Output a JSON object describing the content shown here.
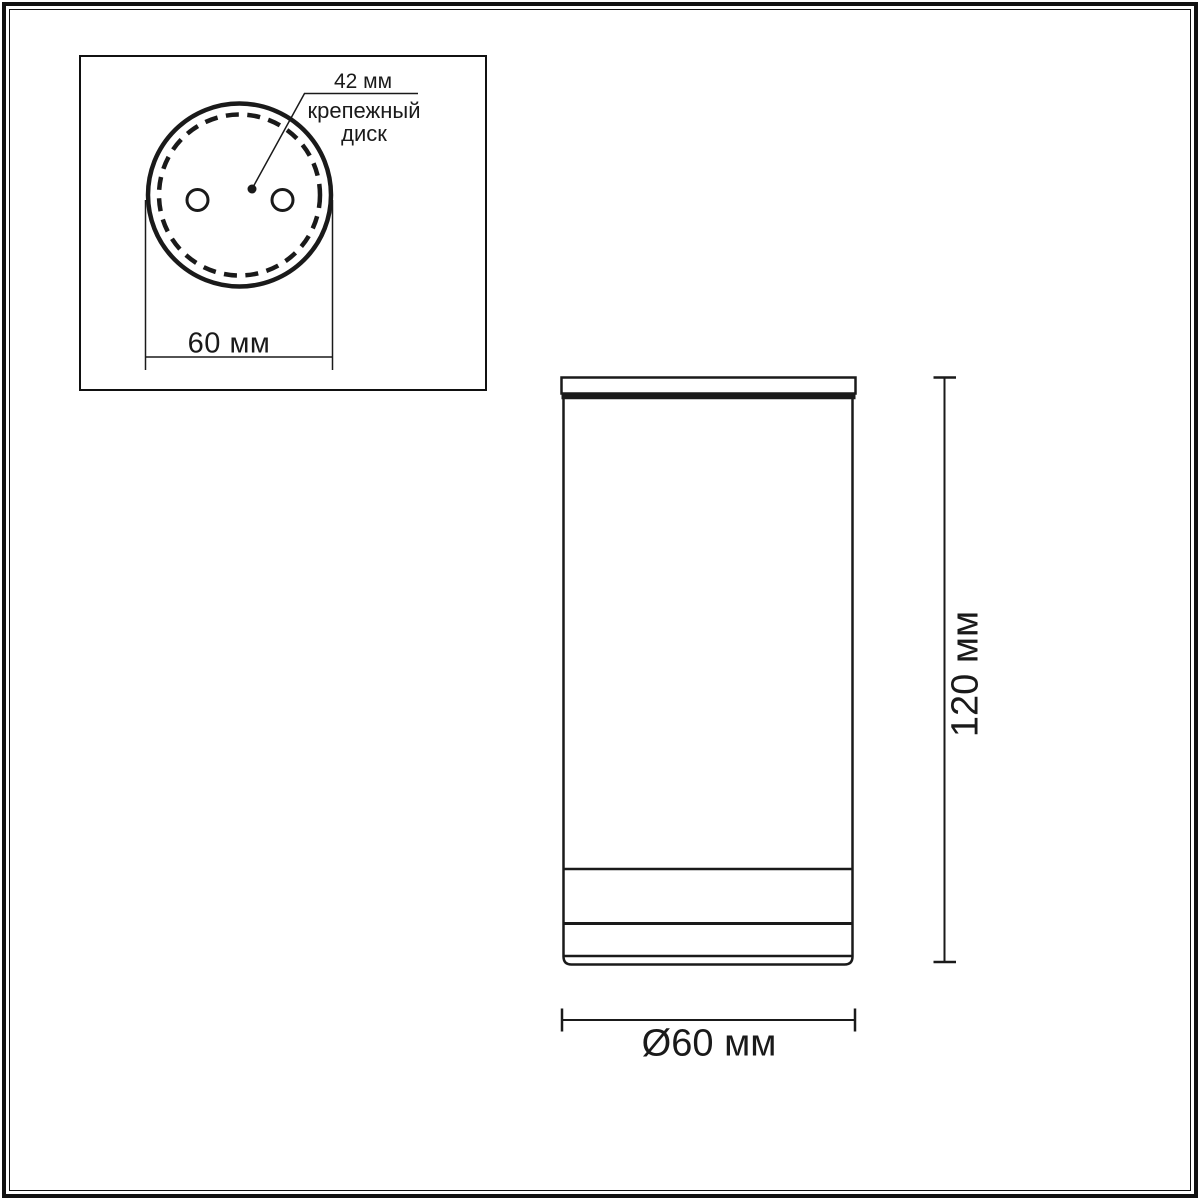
{
  "colors": {
    "ink": "#1a1a1a",
    "frame": "#111111",
    "background": "#ffffff"
  },
  "top_view_inset": {
    "mounting_disc_diameter": "42 мм",
    "mounting_disc_label_line1": "крепежный",
    "mounting_disc_label_line2": "диск",
    "housing_diameter": "60 мм"
  },
  "side_view": {
    "height": "120 мм",
    "diameter": "Ø60 мм"
  }
}
